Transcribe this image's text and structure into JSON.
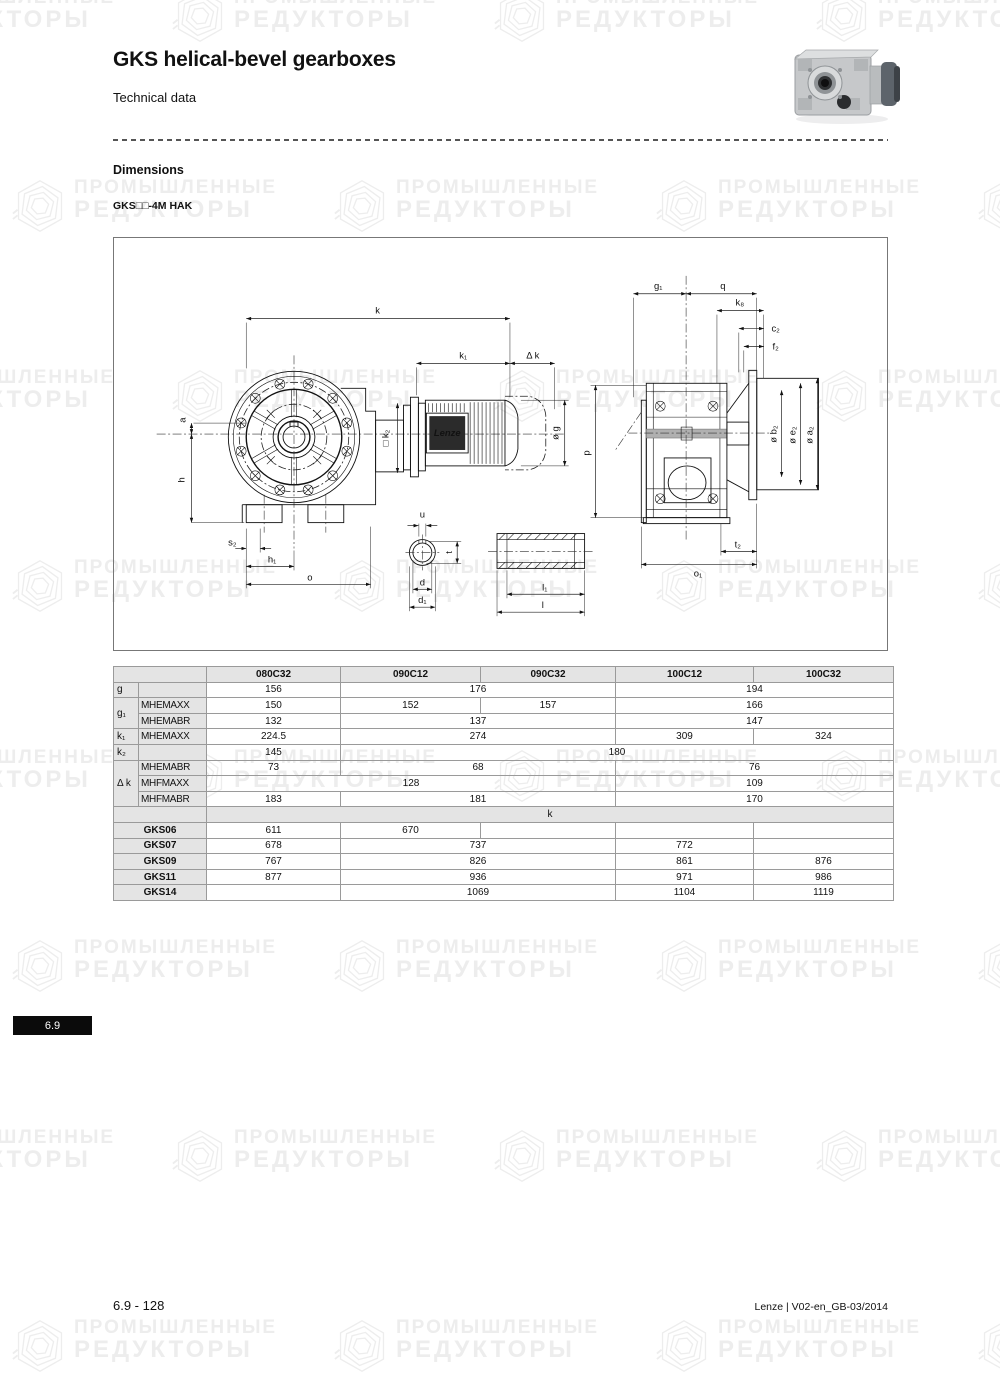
{
  "page": {
    "title": "GKS helical-bevel gearboxes",
    "subtitle": "Technical data",
    "section_heading": "Dimensions",
    "model_label": "GKS□□-4M HAK",
    "tab_number": "6.9",
    "footer_left": "6.9 - 128",
    "footer_right": "Lenze | V02-en_GB-03/2014"
  },
  "watermark": {
    "line1": "ПРОМЫШЛЕННЫЕ",
    "line2": "РЕДУКТОРЫ",
    "color": "#ededed"
  },
  "drawing": {
    "brand": "Lenze",
    "labels": {
      "k": "k",
      "k1": "k₁",
      "dk": "Δ k",
      "a": "a",
      "h": "h",
      "s2": "s₂",
      "h1": "h₁",
      "o": "o",
      "k2": "□ k₂",
      "og": "ø g",
      "u": "u",
      "t": "t",
      "d": "d",
      "d1": "d₁",
      "l": "l",
      "l1": "l₁",
      "g1": "g₁",
      "q": "q",
      "k8": "k₈",
      "c2": "c₂",
      "f2": "f₂",
      "b2": "ø b₂",
      "e2": "ø e₂",
      "a2": "ø a₂",
      "p": "p",
      "t2": "t₂",
      "o1": "o₁"
    }
  },
  "table": {
    "rows": [
      [
        {
          "t": "",
          "cs": 2,
          "ty": "hdr"
        },
        {
          "t": "080C32",
          "ty": "hdr"
        },
        {
          "t": "090C12",
          "ty": "hdr"
        },
        {
          "t": "090C32",
          "ty": "hdr"
        },
        {
          "t": "100C12",
          "ty": "hdr"
        },
        {
          "t": "100C32",
          "ty": "hdr"
        }
      ],
      [
        {
          "t": "g",
          "ty": "sym"
        },
        {
          "t": "",
          "ty": "lbl"
        },
        {
          "t": "156"
        },
        {
          "t": "176",
          "cs": 2
        },
        {
          "t": "194",
          "cs": 2
        }
      ],
      [
        {
          "t": "g₁",
          "rs": 2,
          "ty": "sym"
        },
        {
          "t": "MHEMAXX",
          "ty": "lbl"
        },
        {
          "t": "150"
        },
        {
          "t": "152"
        },
        {
          "t": "157"
        },
        {
          "t": "166",
          "cs": 2
        }
      ],
      [
        {
          "t": "MHEMABR",
          "ty": "lbl"
        },
        {
          "t": "132"
        },
        {
          "t": "137",
          "cs": 2
        },
        {
          "t": "147",
          "cs": 2
        }
      ],
      [
        {
          "t": "k₁",
          "ty": "sym"
        },
        {
          "t": "MHEMAXX",
          "ty": "lbl"
        },
        {
          "t": "224.5"
        },
        {
          "t": "274",
          "cs": 2
        },
        {
          "t": "309"
        },
        {
          "t": "324"
        }
      ],
      [
        {
          "t": "k₂",
          "ty": "sym"
        },
        {
          "t": "",
          "ty": "lbl"
        },
        {
          "t": "145"
        },
        {
          "t": "180",
          "cs": 4
        }
      ],
      [
        {
          "t": "Δ k",
          "rs": 3,
          "ty": "sym"
        },
        {
          "t": "MHEMABR",
          "ty": "lbl"
        },
        {
          "t": "73"
        },
        {
          "t": "68",
          "cs": 2
        },
        {
          "t": "76",
          "cs": 2
        }
      ],
      [
        {
          "t": "MHFMAXX",
          "ty": "lbl"
        },
        {
          "t": "128",
          "cs": 3
        },
        {
          "t": "109",
          "cs": 2
        }
      ],
      [
        {
          "t": "MHFMABR",
          "ty": "lbl"
        },
        {
          "t": "183"
        },
        {
          "t": "181",
          "cs": 2
        },
        {
          "t": "170",
          "cs": 2
        }
      ],
      [
        {
          "t": "",
          "cs": 2,
          "ty": "khdr"
        },
        {
          "t": "k",
          "cs": 5,
          "ty": "khdr"
        }
      ],
      [
        {
          "t": "GKS06",
          "cs": 2,
          "ty": "rowhdr"
        },
        {
          "t": "611"
        },
        {
          "t": "670"
        },
        {
          "t": ""
        },
        {
          "t": ""
        },
        {
          "t": ""
        }
      ],
      [
        {
          "t": "GKS07",
          "cs": 2,
          "ty": "rowhdr"
        },
        {
          "t": "678"
        },
        {
          "t": "737",
          "cs": 2
        },
        {
          "t": "772"
        },
        {
          "t": ""
        }
      ],
      [
        {
          "t": "GKS09",
          "cs": 2,
          "ty": "rowhdr"
        },
        {
          "t": "767"
        },
        {
          "t": "826",
          "cs": 2
        },
        {
          "t": "861"
        },
        {
          "t": "876"
        }
      ],
      [
        {
          "t": "GKS11",
          "cs": 2,
          "ty": "rowhdr"
        },
        {
          "t": "877"
        },
        {
          "t": "936",
          "cs": 2
        },
        {
          "t": "971"
        },
        {
          "t": "986"
        }
      ],
      [
        {
          "t": "GKS14",
          "cs": 2,
          "ty": "rowhdr"
        },
        {
          "t": ""
        },
        {
          "t": "1069",
          "cs": 2
        },
        {
          "t": "1104"
        },
        {
          "t": "1119"
        }
      ]
    ]
  }
}
